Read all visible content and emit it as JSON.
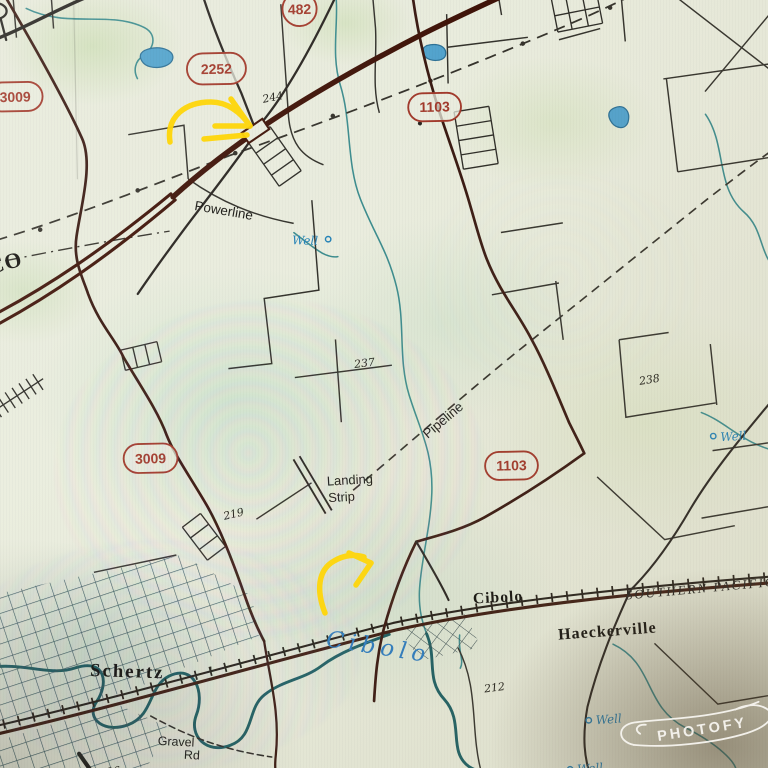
{
  "watermark": {
    "brand": "PHOTOFY"
  },
  "map": {
    "county_label": "CO",
    "place_labels": {
      "schertz": "Schertz",
      "cibolo_town": "Cibolo",
      "haeckerville": "Haeckerville"
    },
    "railroad_label": "SOUTHERN  PACIFIC",
    "creek_label": "Cibolo",
    "route_shields": [
      {
        "number": "482",
        "shape": "circle"
      },
      {
        "number": "2252",
        "shape": "oval"
      },
      {
        "number": "3009",
        "shape": "oval"
      },
      {
        "number": "1103",
        "shape": "oval"
      },
      {
        "number": "3009",
        "shape": "oval"
      },
      {
        "number": "1103",
        "shape": "oval"
      }
    ],
    "feature_labels": {
      "powerline": "Powerline",
      "pipeline": "Pipeline",
      "landing_strip_line1": "Landing",
      "landing_strip_line2": "Strip",
      "gravel_road_line1": "Gravel",
      "gravel_road_line2": "Rd"
    },
    "spot_elevations": {
      "interchange": "244",
      "central": "237",
      "east": "238",
      "southwest": "219",
      "south": "212",
      "schertz": "226"
    },
    "well_labels": {
      "north": "Well",
      "east": "Well",
      "south": "Well",
      "far_south": "Well"
    },
    "colors": {
      "shield_red": "#a23a2c",
      "water_blue": "#2d7cc0",
      "stream_teal": "#38878a",
      "highway_maroon": "#401409",
      "arrow_yellow": "#ffd60a",
      "paper": "#e9ecdf"
    }
  }
}
